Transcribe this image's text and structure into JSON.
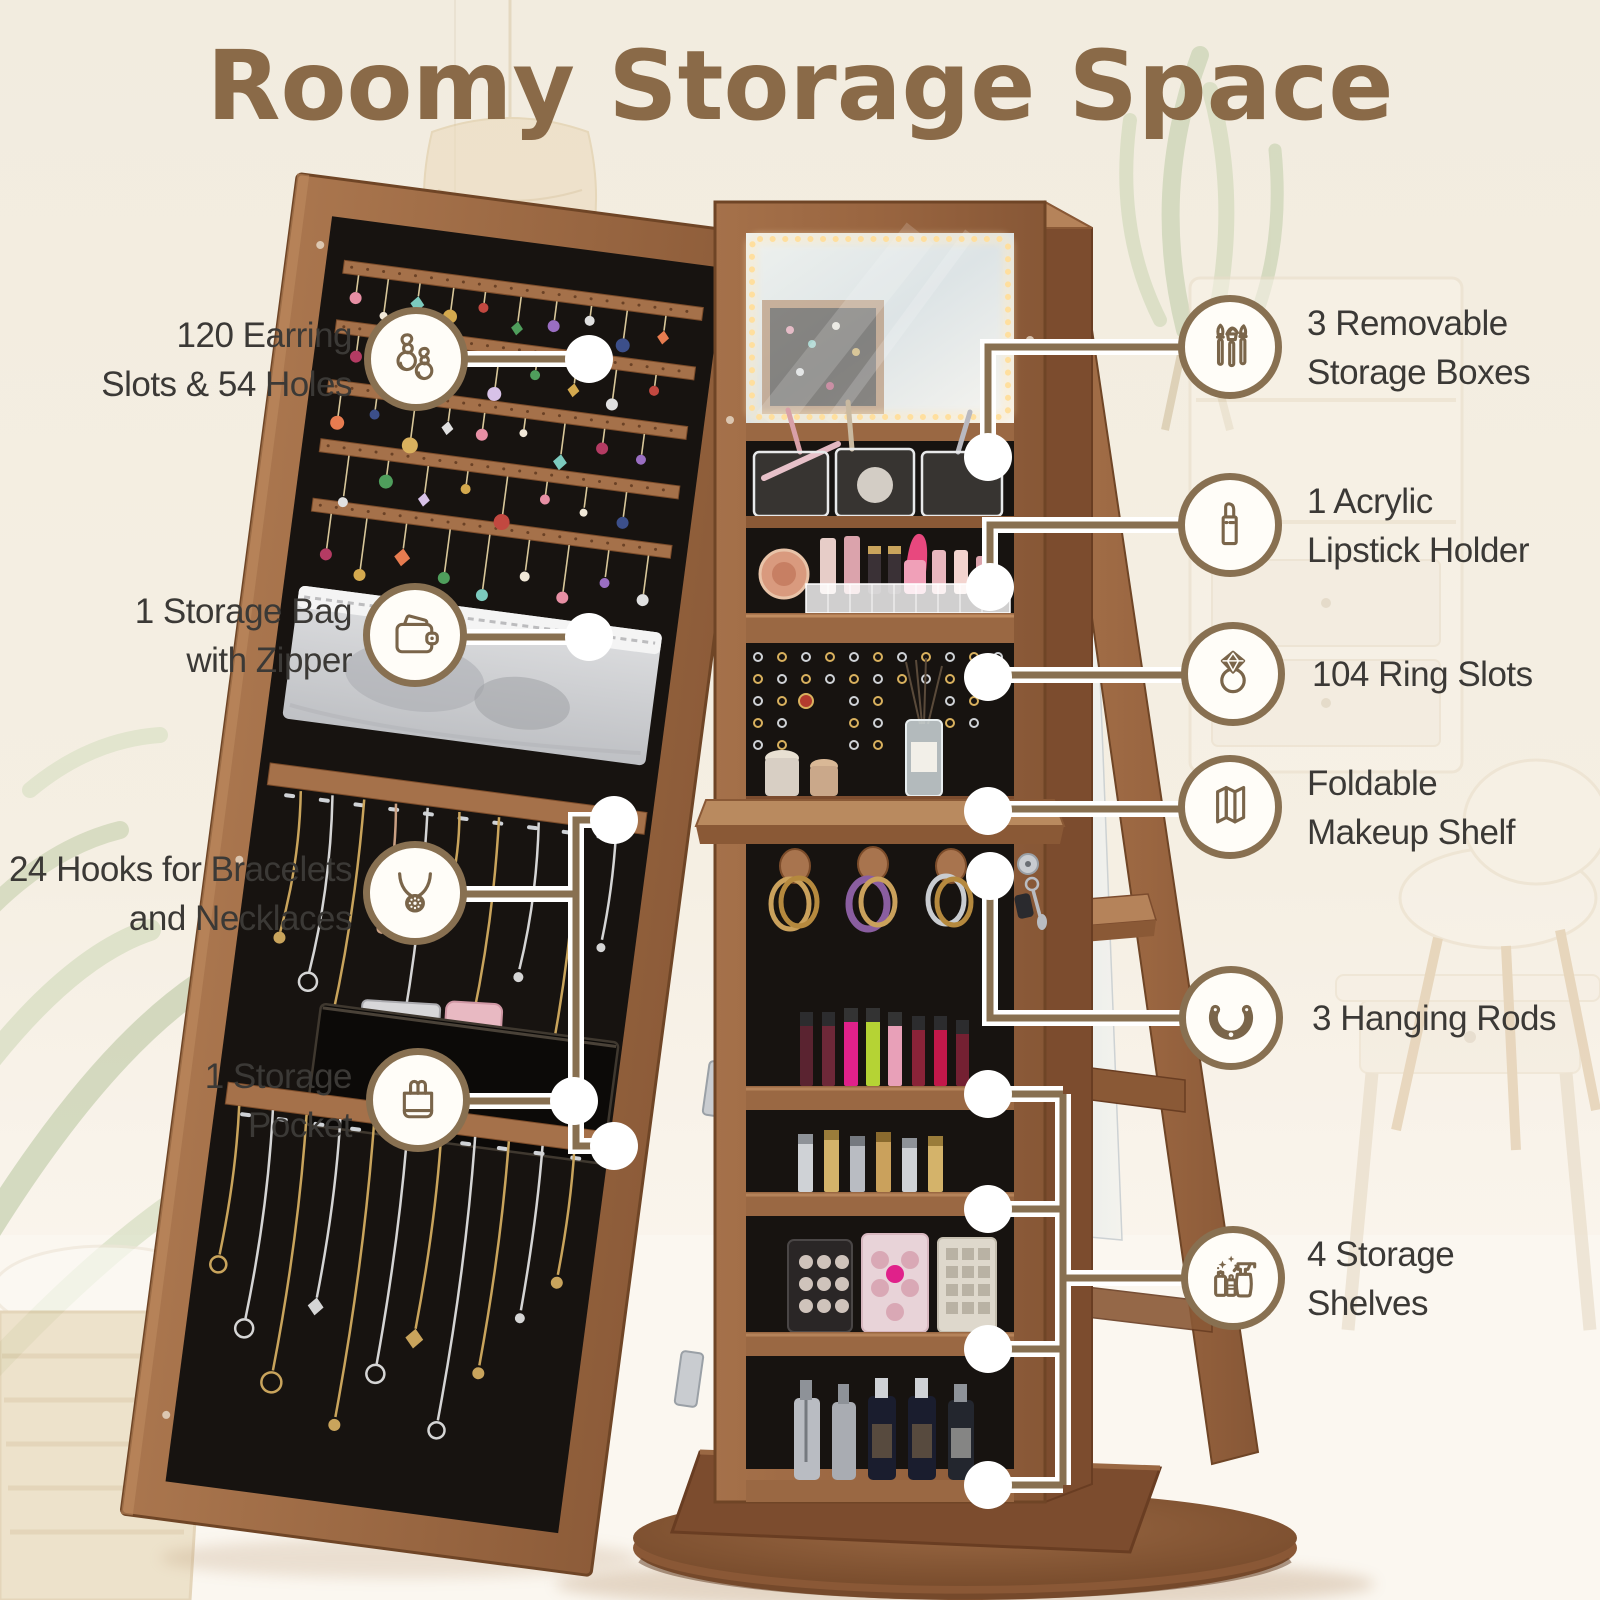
{
  "title": "Roomy Storage Space",
  "theme": {
    "background": "#f4eee2",
    "title_color": "#8a6a48",
    "text_color": "#3b3936",
    "accent_brown": "#887051",
    "callout_circle_fill": "#fffdf8",
    "wood_brown": "#9a6843",
    "interior_black": "#171310",
    "led_glow": "#ffdf9e"
  },
  "callouts": {
    "left": [
      {
        "icon": "earrings-icon",
        "label_lines": [
          "120 Earring",
          "Slots & 54 Holes"
        ]
      },
      {
        "icon": "wallet-icon",
        "label_lines": [
          "1 Storage Bag",
          "with Zipper"
        ]
      },
      {
        "icon": "necklace-icon",
        "label_lines": [
          "24 Hooks for Bracelets",
          "and Necklaces"
        ]
      },
      {
        "icon": "shopping-bag-icon",
        "label_lines": [
          "1 Storage",
          "Pocket"
        ]
      }
    ],
    "right": [
      {
        "icon": "makeup-brushes-icon",
        "label_lines": [
          "3 Removable",
          "Storage Boxes"
        ]
      },
      {
        "icon": "lipstick-icon",
        "label_lines": [
          "1 Acrylic",
          "Lipstick Holder"
        ]
      },
      {
        "icon": "diamond-ring-icon",
        "label_lines": [
          "104 Ring Slots"
        ]
      },
      {
        "icon": "foldable-shelf-icon",
        "label_lines": [
          "Foldable",
          "Makeup Shelf"
        ]
      },
      {
        "icon": "bracelet-icon",
        "label_lines": [
          "3 Hanging Rods"
        ]
      },
      {
        "icon": "cleaning-bottles-icon",
        "label_lines": [
          "4 Storage",
          "Shelves"
        ]
      }
    ]
  }
}
